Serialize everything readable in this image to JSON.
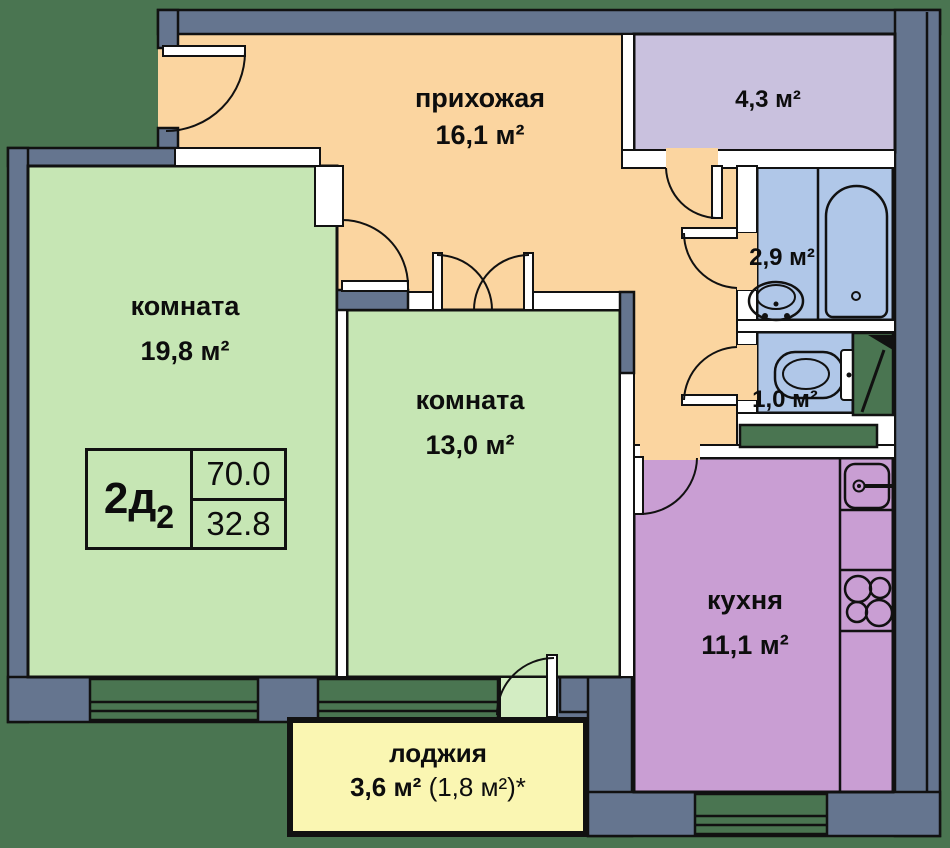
{
  "rooms": {
    "hallway": {
      "name": "прихожая",
      "area": "16,1 м²"
    },
    "room_1": {
      "name": "комната",
      "area": "19,8 м²"
    },
    "room_2": {
      "name": "комната",
      "area": "13,0 м²"
    },
    "kitchen": {
      "name": "кухня",
      "area": "11,1 м²"
    },
    "wardrobe": {
      "area": "4,3 м²"
    },
    "bathroom": {
      "area": "2,9 м²"
    },
    "wc": {
      "area": "1,0 м²"
    },
    "loggia": {
      "name": "лоджия",
      "area": "3,6 м²",
      "area_note": " (1,8 м²)*"
    }
  },
  "badge": {
    "type_main": "2д",
    "type_index": "2",
    "total_area": "70.0",
    "living_area": "32.8"
  },
  "colors": {
    "background": "#4a7551",
    "wall": "#65758f",
    "hallway": "#fbd5a0",
    "room_green": "#c6e6b4",
    "wardrobe_lilac": "#c9c1de",
    "bathroom_blue": "#b0c7e8",
    "kitchen_purple": "#c99ed3",
    "loggia_yellow": "#faf6b2",
    "line": "#111111"
  }
}
